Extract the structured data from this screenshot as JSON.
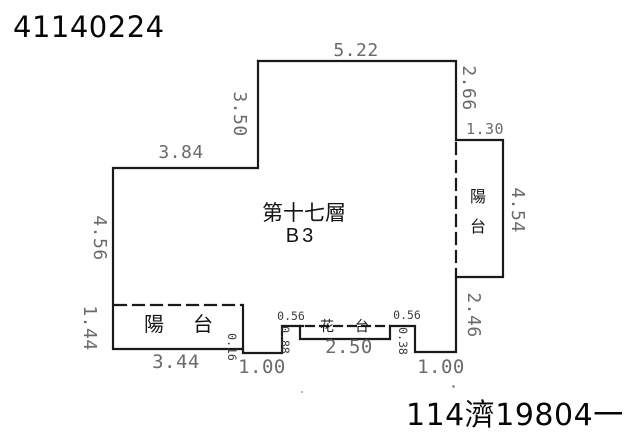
{
  "header": {
    "document_number": "41140224"
  },
  "footer": {
    "case_number": "114濟19804一"
  },
  "plan": {
    "floor_label": "第十七層",
    "unit_label": "B3",
    "rooms": {
      "balcony_left_char1": "陽",
      "balcony_left_char2": "台",
      "balcony_right_char1": "陽",
      "balcony_right_char2": "台",
      "flower_bed_char1": "花",
      "flower_bed_char2": "台"
    },
    "dimensions": {
      "top_width": "5.22",
      "right_upper": "2.66",
      "balcony_right_top": "1.30",
      "left_upper": "3.50",
      "upper_step_width": "3.84",
      "left_middle": "4.56",
      "left_lower": "1.44",
      "balcony_right_height": "4.54",
      "right_lower": "2.46",
      "balcony_left_bottom": "3.44",
      "balcony_left_offset": "0.16",
      "bottom_left_segment": "1.00",
      "flower_bed_left_width": "0.56",
      "flower_bed_left_depth": "0.88",
      "flower_bed_width": "2.50",
      "flower_bed_right_depth": "0.38",
      "flower_bed_right_width": "0.56",
      "bottom_right_segment": "1.00"
    },
    "colors": {
      "background": "#ffffff",
      "outline": "#1a1a1a",
      "dimension_text": "#6b6b6b",
      "label_text": "#141414"
    }
  }
}
